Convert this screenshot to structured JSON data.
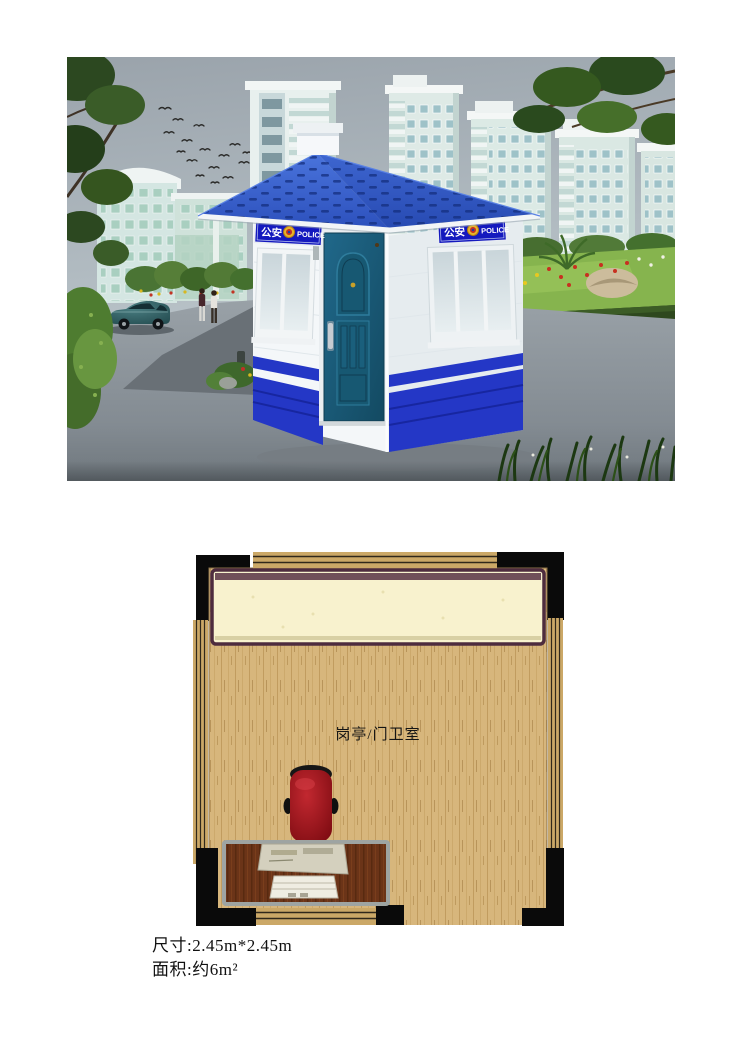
{
  "photo": {
    "booth_sign": {
      "cn": "公安",
      "en": "POLICE"
    },
    "colors": {
      "roof_blue": "#3a63cf",
      "sign_blue": "#1419be",
      "door_teal": "#1c5f7e",
      "skirt_blue": "#2437c6",
      "wall_white": "#f4f7f9",
      "sky_gray": "#a4adb4",
      "road_gray": "#8b939a"
    }
  },
  "floor_plan": {
    "room_label": "岗亭/门卫室",
    "colors": {
      "floor_tan": "#d7b67c",
      "counter_cream": "#f8f2ce",
      "counter_border": "#4e2c3e",
      "desk_brown": "#6b3418",
      "chair_red": "#a01824",
      "column_black": "#0a0a0a"
    }
  },
  "specs": {
    "lines": [
      "尺寸:2.45m*2.45m",
      "面积:约6m²"
    ]
  }
}
